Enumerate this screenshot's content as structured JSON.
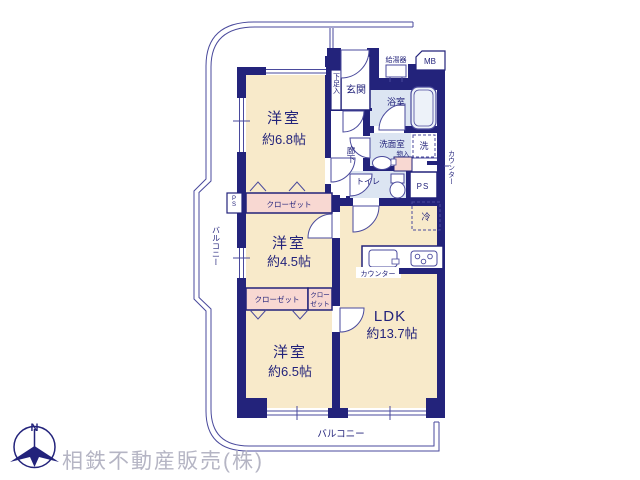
{
  "colors": {
    "wall": "#23237B",
    "line": "#4A4A9C",
    "room_cream": "#F8EACA",
    "wet_blue": "#DCE5F2",
    "closet_pink": "#F8D8D2",
    "company_gray": "#B5B5C4"
  },
  "rooms": {
    "bedroom1": {
      "name": "洋室",
      "size": "約6.8帖"
    },
    "bedroom2": {
      "name": "洋室",
      "size": "約4.5帖"
    },
    "bedroom3": {
      "name": "洋室",
      "size": "約6.5帖"
    },
    "ldk": {
      "name": "LDK",
      "size": "約13.7帖"
    }
  },
  "labels": {
    "entrance": "玄関",
    "shoe_box": "下足入",
    "bathroom": "浴室",
    "washroom": "洗面室",
    "storage": "物入",
    "washer": "洗",
    "toilet": "トイレ",
    "hallway": "廊下",
    "water_heater": "給湯器",
    "meter_box": "MB",
    "pipe_space_right": "PS",
    "pipe_space_left": "PS",
    "refrigerator": "冷",
    "kitchen_counter": "カウンター",
    "side_counter": "カウンター",
    "closet_top": "クローゼット",
    "closet_bottom": "クローゼット",
    "closet_small_line1": "クロー",
    "closet_small_line2": "ゼット",
    "balcony_left": "バルコニー",
    "balcony_bottom": "バルコニー"
  },
  "compass": {
    "north": "N"
  },
  "footer": {
    "company": "相鉄不動産販売(株)"
  }
}
